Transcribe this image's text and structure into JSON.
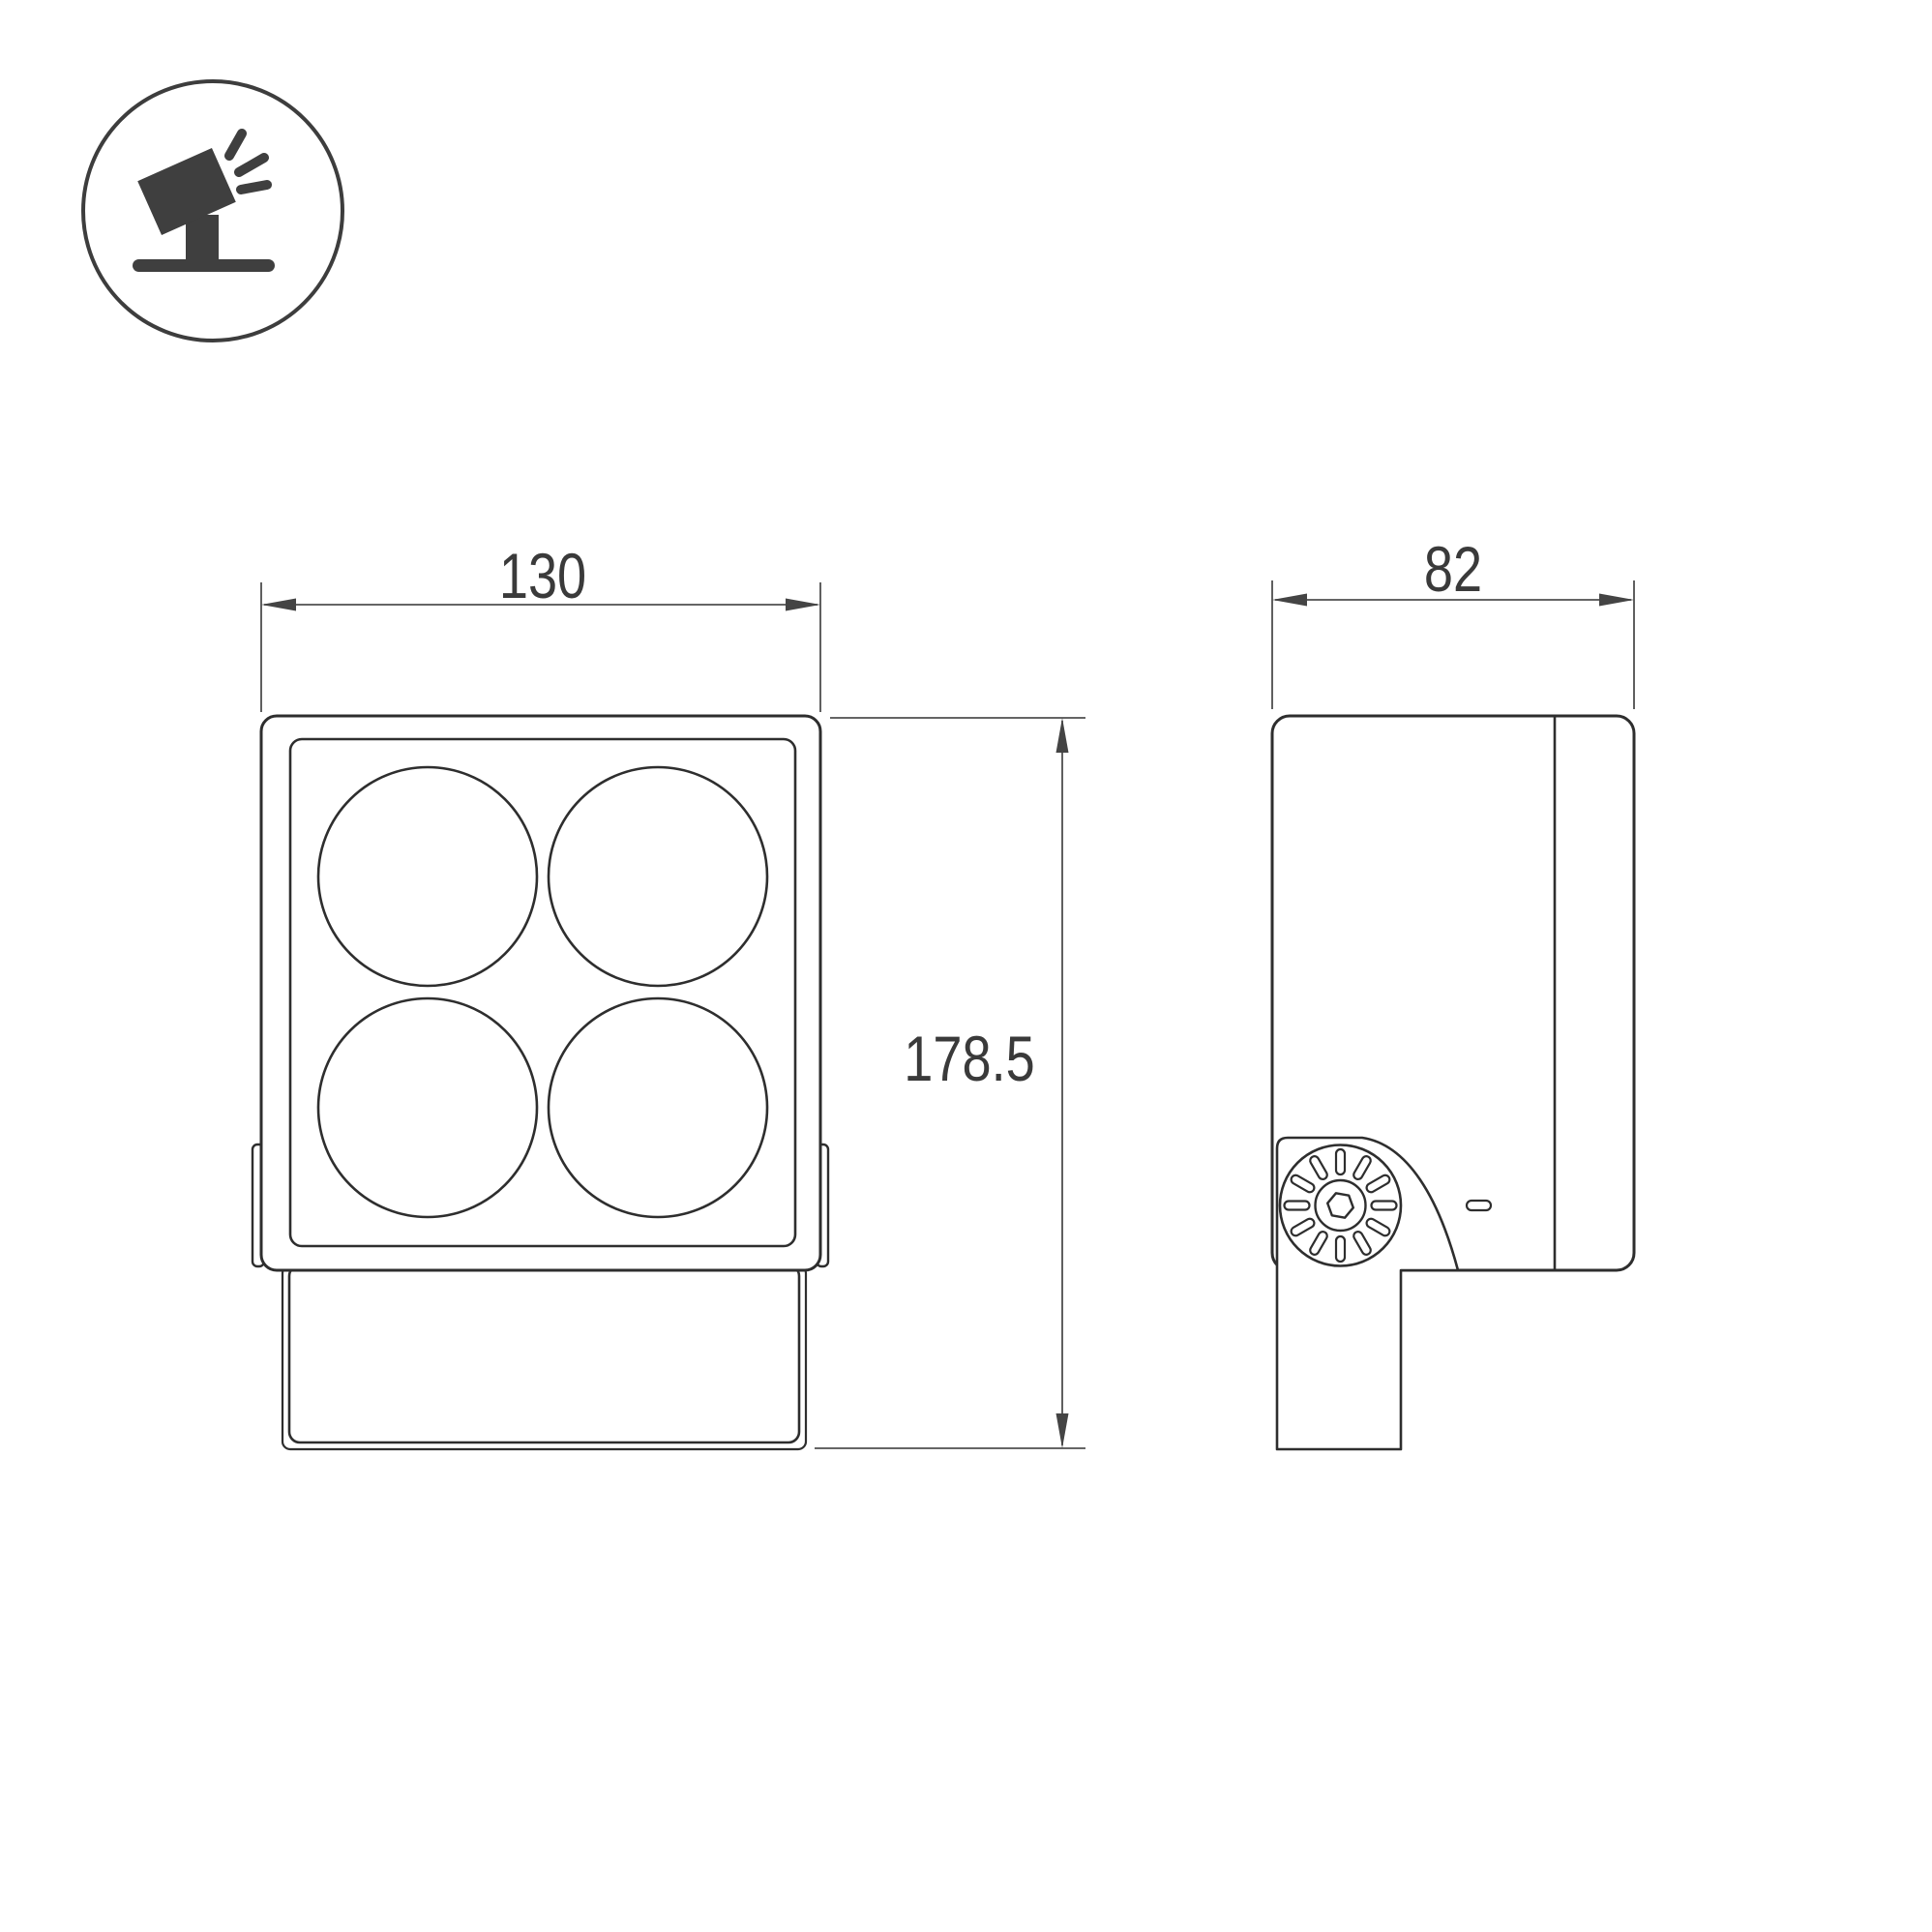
{
  "icon": {
    "name": "tilted-floodlight-on-ground-icon"
  },
  "dimensions": {
    "front_width": "130",
    "overall_height": "178.5",
    "side_depth": "82"
  },
  "colors": {
    "outline": "#2e2e2e",
    "dimension_line": "#4f4f4f",
    "arrow_fill": "#444444",
    "text": "#3a3a3a",
    "icon_fill": "#3f3f3f",
    "background": "#ffffff"
  }
}
